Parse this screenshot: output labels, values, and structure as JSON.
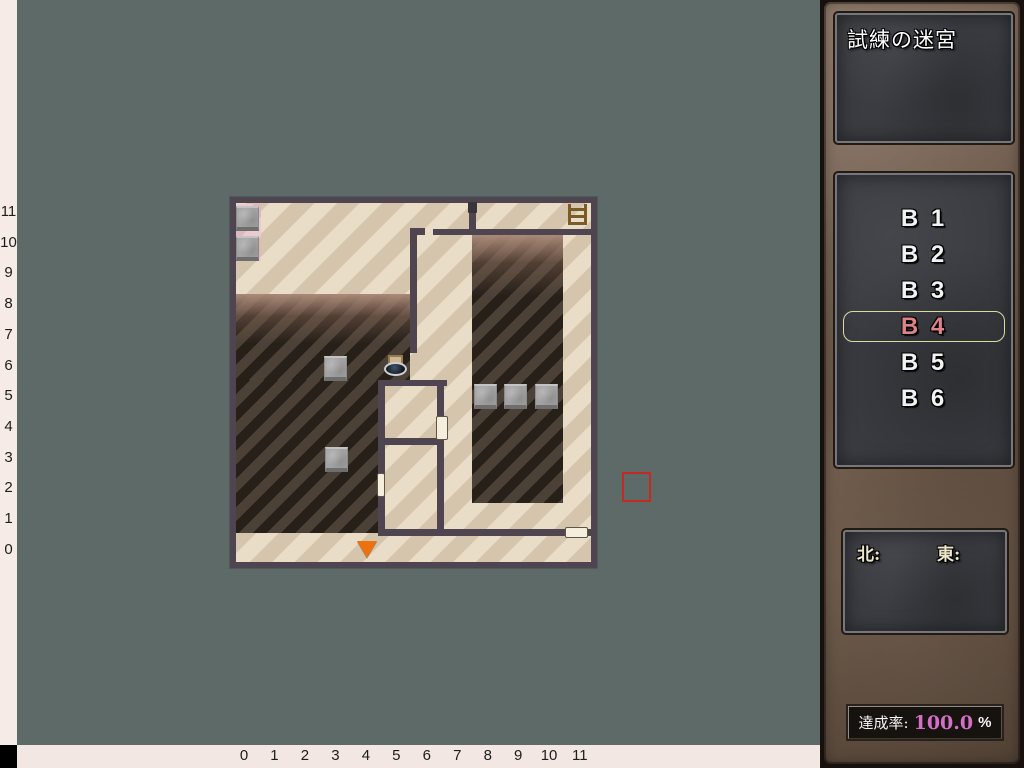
{
  "colors": {
    "background": "#5e6a68",
    "wall": "#4f4550",
    "selected_floor_text": "#dd8288",
    "selection_border": "#d9db9f",
    "achievement_value": "#d46fc8",
    "player_marker": "#ee7110",
    "map_cursor": "#c32a22"
  },
  "sidebar": {
    "title": "試練の迷宮",
    "floors": [
      {
        "label": "B 1",
        "selected": false
      },
      {
        "label": "B 2",
        "selected": false
      },
      {
        "label": "B 3",
        "selected": false
      },
      {
        "label": "B 4",
        "selected": true
      },
      {
        "label": "B 5",
        "selected": false
      },
      {
        "label": "B 6",
        "selected": false
      }
    ],
    "compass": {
      "north": "北:",
      "east": "東:"
    },
    "achievement": {
      "label": "達成率:",
      "value": "100.0",
      "unit": "%"
    }
  },
  "axes": {
    "y": [
      "11",
      "10",
      "9",
      "8",
      "7",
      "6",
      "5",
      "4",
      "3",
      "2",
      "1",
      "0"
    ],
    "x": [
      "0",
      "1",
      "2",
      "3",
      "4",
      "5",
      "6",
      "7",
      "8",
      "9",
      "10",
      "11"
    ]
  }
}
